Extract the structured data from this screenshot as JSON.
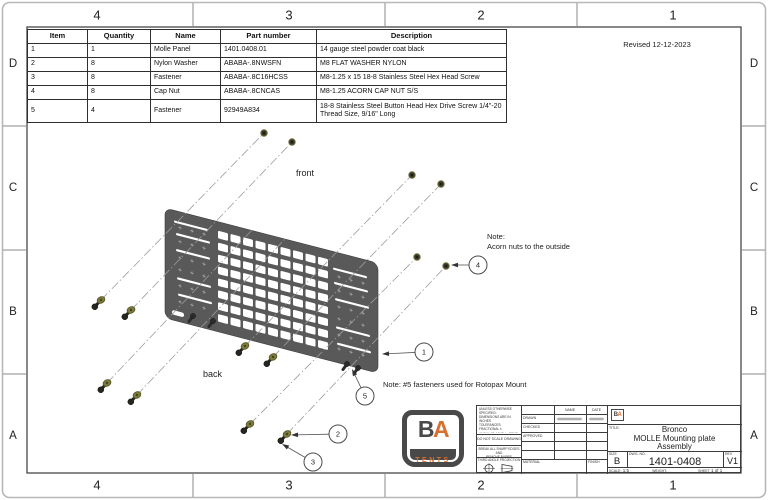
{
  "sheet": {
    "zones_h": [
      "4",
      "3",
      "2",
      "1"
    ],
    "zones_v": [
      "D",
      "C",
      "B",
      "A"
    ],
    "revised": "Revised 12-12-2023"
  },
  "bom": {
    "headers": [
      "Item",
      "Quantity",
      "Name",
      "Part number",
      "Description"
    ],
    "rows": [
      [
        "1",
        "1",
        "Molle Panel",
        "1401.0408.01",
        "14 gauge steel powder coat black"
      ],
      [
        "2",
        "8",
        "Nylon Washer",
        "ABABA-.8NWSFN",
        "M8 FLAT WASHER NYLON"
      ],
      [
        "3",
        "8",
        "Fastener",
        "ABABA-.8C16HCSS",
        "M8-1.25 x 15 18-8 Stainless Steel Hex Head Screw"
      ],
      [
        "4",
        "8",
        "Cap Nut",
        "ABABA-.8CNCAS",
        "M8-1.25 ACORN CAP NUT S/S"
      ],
      [
        "5",
        "4",
        "Fastener",
        "92949A834",
        "18-8 Stainless Steel Button Head Hex Drive Screw 1/4\"-20 Thread Size, 9/16\" Long"
      ]
    ]
  },
  "view": {
    "label_front": "front",
    "label_back": "back",
    "note_acorn_1": "Note:",
    "note_acorn_2": "Acorn nuts to the outside",
    "note_rotopax": "Note: #5 fasteners used for Rotopax Mount",
    "balloons": [
      "1",
      "2",
      "3",
      "4",
      "5"
    ]
  },
  "title_block": {
    "tolerance_lines": [
      "UNLESS OTHERWISE SPECIFIED:",
      "DIMENSIONS ARE IN INCHES",
      "TOLERANCES:",
      "FRACTIONAL ±",
      "ANGULAR: MACH ±  BEND ±",
      "TWO PLACE DECIMAL    ±",
      "THREE PLACE DECIMAL  ±",
      "SURFACE FINISH"
    ],
    "do_not_scale": "DO NOT SCALE DRAWING",
    "break_edges_1": "BREAK ALL SHARP EDGES AND",
    "break_edges_2": "REMOVE BURRS",
    "projection": "THIRD ANGLE PROJECTION",
    "col_name": "NAME",
    "col_date": "DATE",
    "row_drawn": "DRAWN",
    "row_checked": "CHECKED",
    "row_approved": "APPROVED",
    "material": "MATERIAL",
    "finish": "FINISH",
    "title_label": "TITLE:",
    "title_lines": [
      "Bronco",
      "MOLLE Mounting plate",
      "Assembly"
    ],
    "size_label": "SIZE",
    "size": "B",
    "dwg_label": "DWG. NO.",
    "dwg_no": "1401-0408",
    "rev_label": "REV",
    "rev": "V1",
    "scale_label": "SCALE:",
    "scale_value": "1:5",
    "weight_label": "WEIGHT:",
    "sheet_label": "SHEET",
    "sheet_value": "1 of 1",
    "logo_b": "B",
    "logo_a": "A",
    "logo_tents": "TENTS"
  },
  "colors": {
    "accent_orange": "#d96f2e",
    "panel_gray": "#595959",
    "washer_olive": "#7c7b3f",
    "hardware_dark": "#26261e",
    "frame_gray": "#474747"
  }
}
